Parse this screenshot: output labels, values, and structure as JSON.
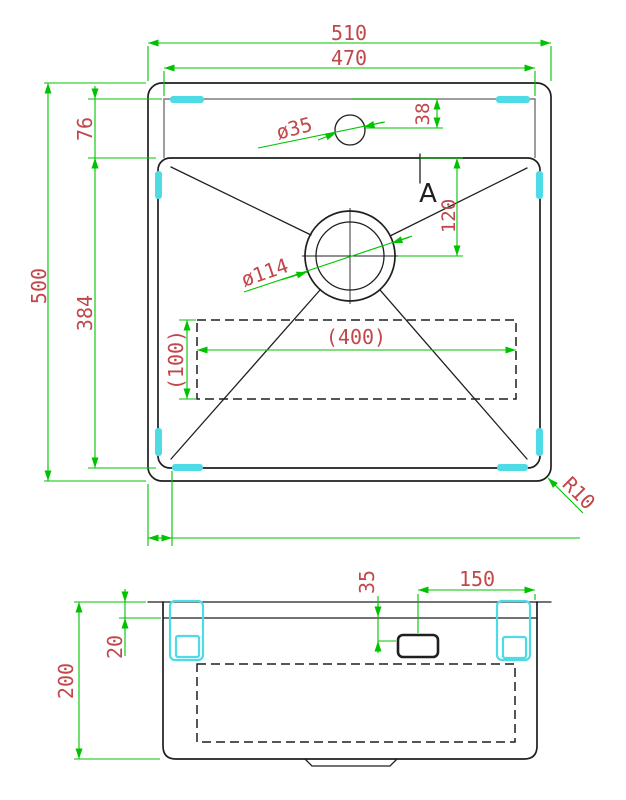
{
  "drawing_type": "CAD technical drawing - kitchen sink, top view and side section view",
  "colors": {
    "outline_color": "#1f1f1f",
    "secondary_line_color": "#7d7d7d",
    "dimension_color": "#00c300",
    "dimension_text_color": "#c1474b",
    "highlight_color": "#4fdbe6",
    "background_color": "#ffffff"
  },
  "top_view": {
    "dimensions": {
      "outer_width": "510",
      "rim_inner_width": "470",
      "outer_depth": "500",
      "rim_to_basin": "76",
      "basin_depth": "384",
      "faucet_hole_offset": "38",
      "faucet_hole_diameter": "ø35",
      "drain_offset": "120",
      "drain_diameter": "ø114",
      "base_pad_width": "(400)",
      "base_pad_depth": "(100)",
      "corner_radius": "R10"
    },
    "section_label": "A"
  },
  "side_view": {
    "dimensions": {
      "overall_height": "200",
      "rim_height": "20",
      "bracket_offset": "35",
      "bracket_to_edge": "150"
    }
  }
}
